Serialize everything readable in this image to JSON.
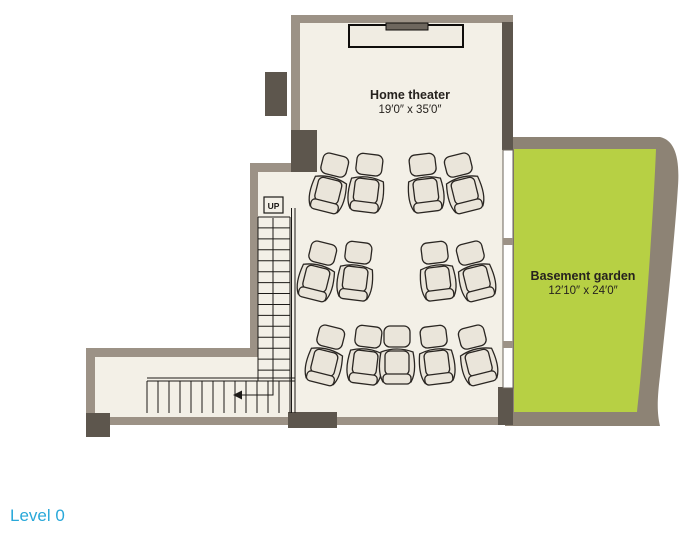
{
  "level_label": "Level 0",
  "rooms": {
    "home_theater": {
      "name": "Home theater",
      "dimensions": "19′0″ x 35′0″"
    },
    "basement_garden": {
      "name": "Basement garden",
      "dimensions": "12′10″ x 24′0″"
    }
  },
  "floorplan": {
    "stairs": {
      "label": "UP",
      "vertical_steps": 15,
      "horizontal_steps": 13
    },
    "seat_rows": [
      {
        "y": 184,
        "seats": [
          {
            "x": 330,
            "r": 14
          },
          {
            "x": 367,
            "r": 7
          },
          {
            "x": 425,
            "r": -7
          },
          {
            "x": 463,
            "r": -14
          }
        ]
      },
      {
        "y": 272,
        "seats": [
          {
            "x": 318,
            "r": 14
          },
          {
            "x": 356,
            "r": 7
          },
          {
            "x": 437,
            "r": -7
          },
          {
            "x": 475,
            "r": -14
          }
        ]
      },
      {
        "y": 356,
        "seats": [
          {
            "x": 326,
            "r": 14
          },
          {
            "x": 366,
            "r": 7
          },
          {
            "x": 397,
            "r": 0
          },
          {
            "x": 436,
            "r": -7
          },
          {
            "x": 477,
            "r": -14
          }
        ]
      }
    ]
  },
  "colors": {
    "floor": "#f3f0e7",
    "wall_light": "#9c9286",
    "wall_dark": "#5d564d",
    "garden_wall": "#8d8375",
    "garden_green": "#b7d044",
    "seat_fill": "#eae5da",
    "line_dark": "#1c1a17",
    "level_blue": "#29a8d9"
  }
}
